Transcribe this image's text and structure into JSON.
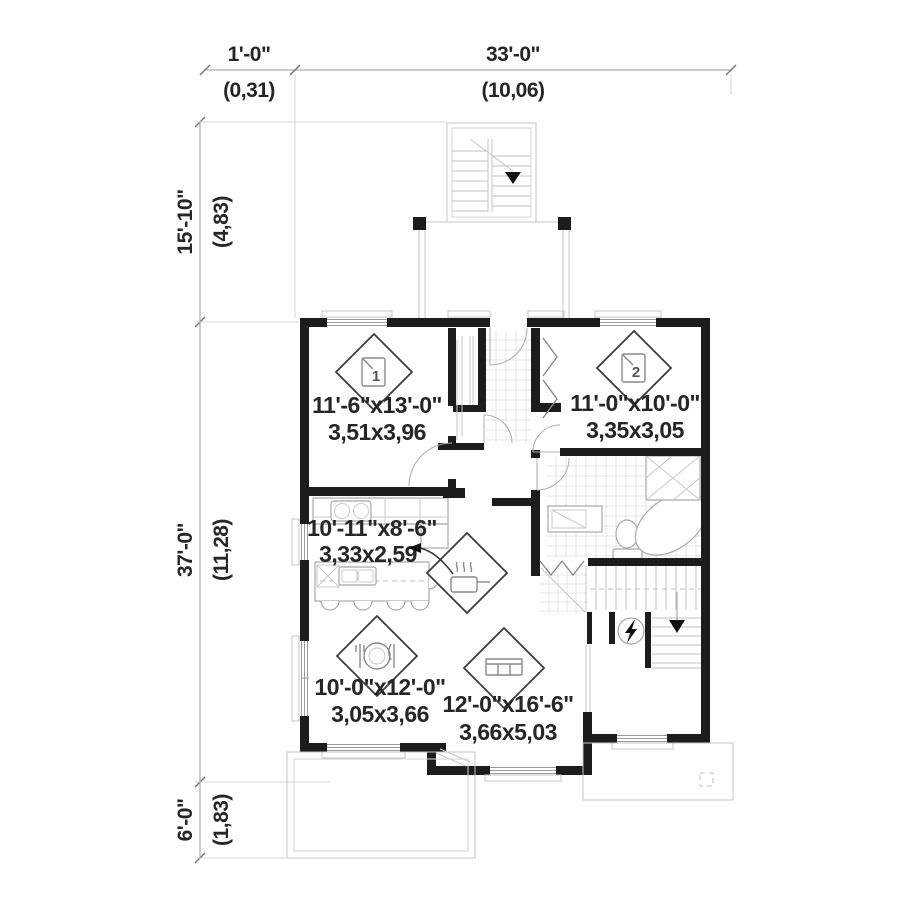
{
  "plan_title": "first-floor-plan",
  "colors": {
    "wall": "#1c1c1c",
    "thin_line": "#9c9c9c",
    "light_line": "#c6c6c6",
    "text": "#262626",
    "background": "#ffffff"
  },
  "dimensions": {
    "top": [
      {
        "feet": "1'-0\"",
        "meters": "(0,31)"
      },
      {
        "feet": "33'-0\"",
        "meters": "(10,06)"
      }
    ],
    "left": [
      {
        "feet": "15'-10\"",
        "meters": "(4,83)"
      },
      {
        "feet": "37'-0\"",
        "meters": "(11,28)"
      },
      {
        "feet": "6'-0\"",
        "meters": "(1,83)"
      }
    ]
  },
  "rooms": [
    {
      "name": "bedroom-1",
      "number": "1",
      "imperial": "11'-6\"x13'-0\"",
      "metric": "3,51x3,96",
      "icon": "bed-number-icon"
    },
    {
      "name": "bedroom-2",
      "number": "2",
      "imperial": "11'-0\"x10'-0\"",
      "metric": "3,35x3,05",
      "icon": "bed-number-icon"
    },
    {
      "name": "kitchen",
      "imperial": "10'-11\"x8'-6\"",
      "metric": "3,33x2,59",
      "icon": "cooking-pot-icon"
    },
    {
      "name": "dining-room",
      "imperial": "10'-0\"x12'-0\"",
      "metric": "3,05x3,66",
      "icon": "plate-cutlery-icon"
    },
    {
      "name": "living-room",
      "imperial": "12'-0\"x16'-6\"",
      "metric": "3,66x5,03",
      "icon": "sofa-icon"
    }
  ],
  "symbols": [
    "stairs-down-arrow",
    "entry-stairs-down-arrow",
    "electrical-panel",
    "kitchen-label-arrow"
  ]
}
